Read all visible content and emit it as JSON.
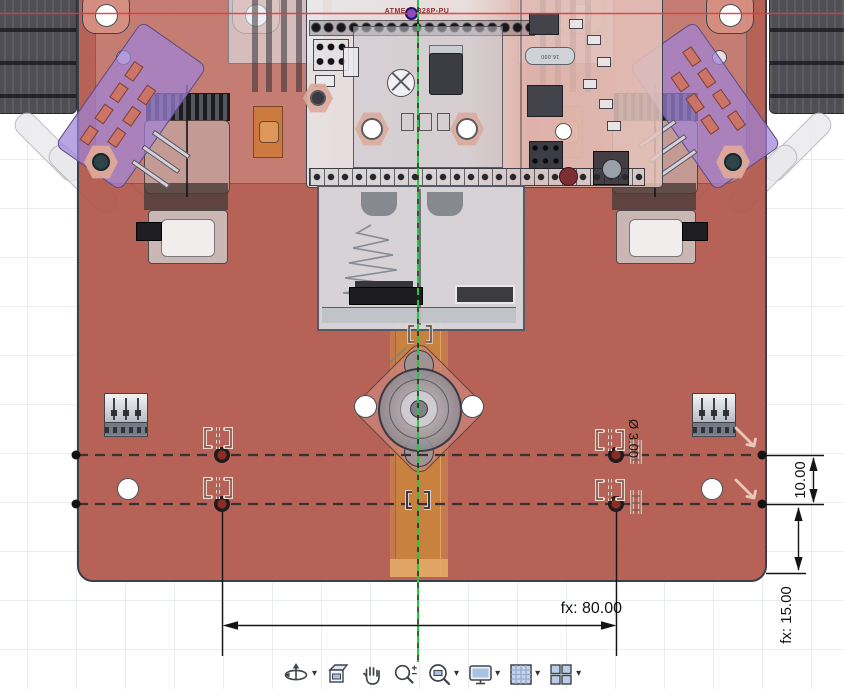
{
  "sketch": {
    "dimensions": {
      "horizontal_spacing": "fx: 80.00",
      "vertical_offset": "10.00",
      "edge_distance": "fx: 15.00",
      "hole_diameter": "Ø 3.00"
    },
    "labels": {
      "mcu": "ATMEGA328P-PU",
      "crystal": "16.000"
    },
    "constraint_icons": [
      "symmetry",
      "symmetry",
      "symmetry",
      "symmetry",
      "symmetry-centerline",
      "vertical",
      "vertical",
      "collinear",
      "collinear"
    ],
    "axes": {
      "x_axis_color": "#e03c3c",
      "centerline_color": "#2ec244"
    }
  },
  "model": {
    "plate_color": "#b1564a",
    "pcb_color": "#e8dcd8",
    "sensor_board_color": "#a082d7",
    "tape_color": "#c8823e",
    "battery_holder_color": "#d8dbe0"
  },
  "toolbar": {
    "items": [
      {
        "name": "orbit",
        "icon": "orbit-icon",
        "has_dropdown": true
      },
      {
        "name": "look-at",
        "icon": "look-at-icon",
        "has_dropdown": false
      },
      {
        "name": "pan",
        "icon": "pan-hand-icon",
        "has_dropdown": false
      },
      {
        "name": "zoom",
        "icon": "magnifier-plus-minus-icon",
        "has_dropdown": false
      },
      {
        "name": "fit",
        "icon": "fit-view-icon",
        "has_dropdown": true
      },
      {
        "name": "display-settings",
        "icon": "monitor-icon",
        "has_dropdown": true
      },
      {
        "name": "grids-and-snaps",
        "icon": "grid-icon",
        "has_dropdown": true
      },
      {
        "name": "viewports",
        "icon": "viewports-icon",
        "has_dropdown": true
      }
    ]
  }
}
